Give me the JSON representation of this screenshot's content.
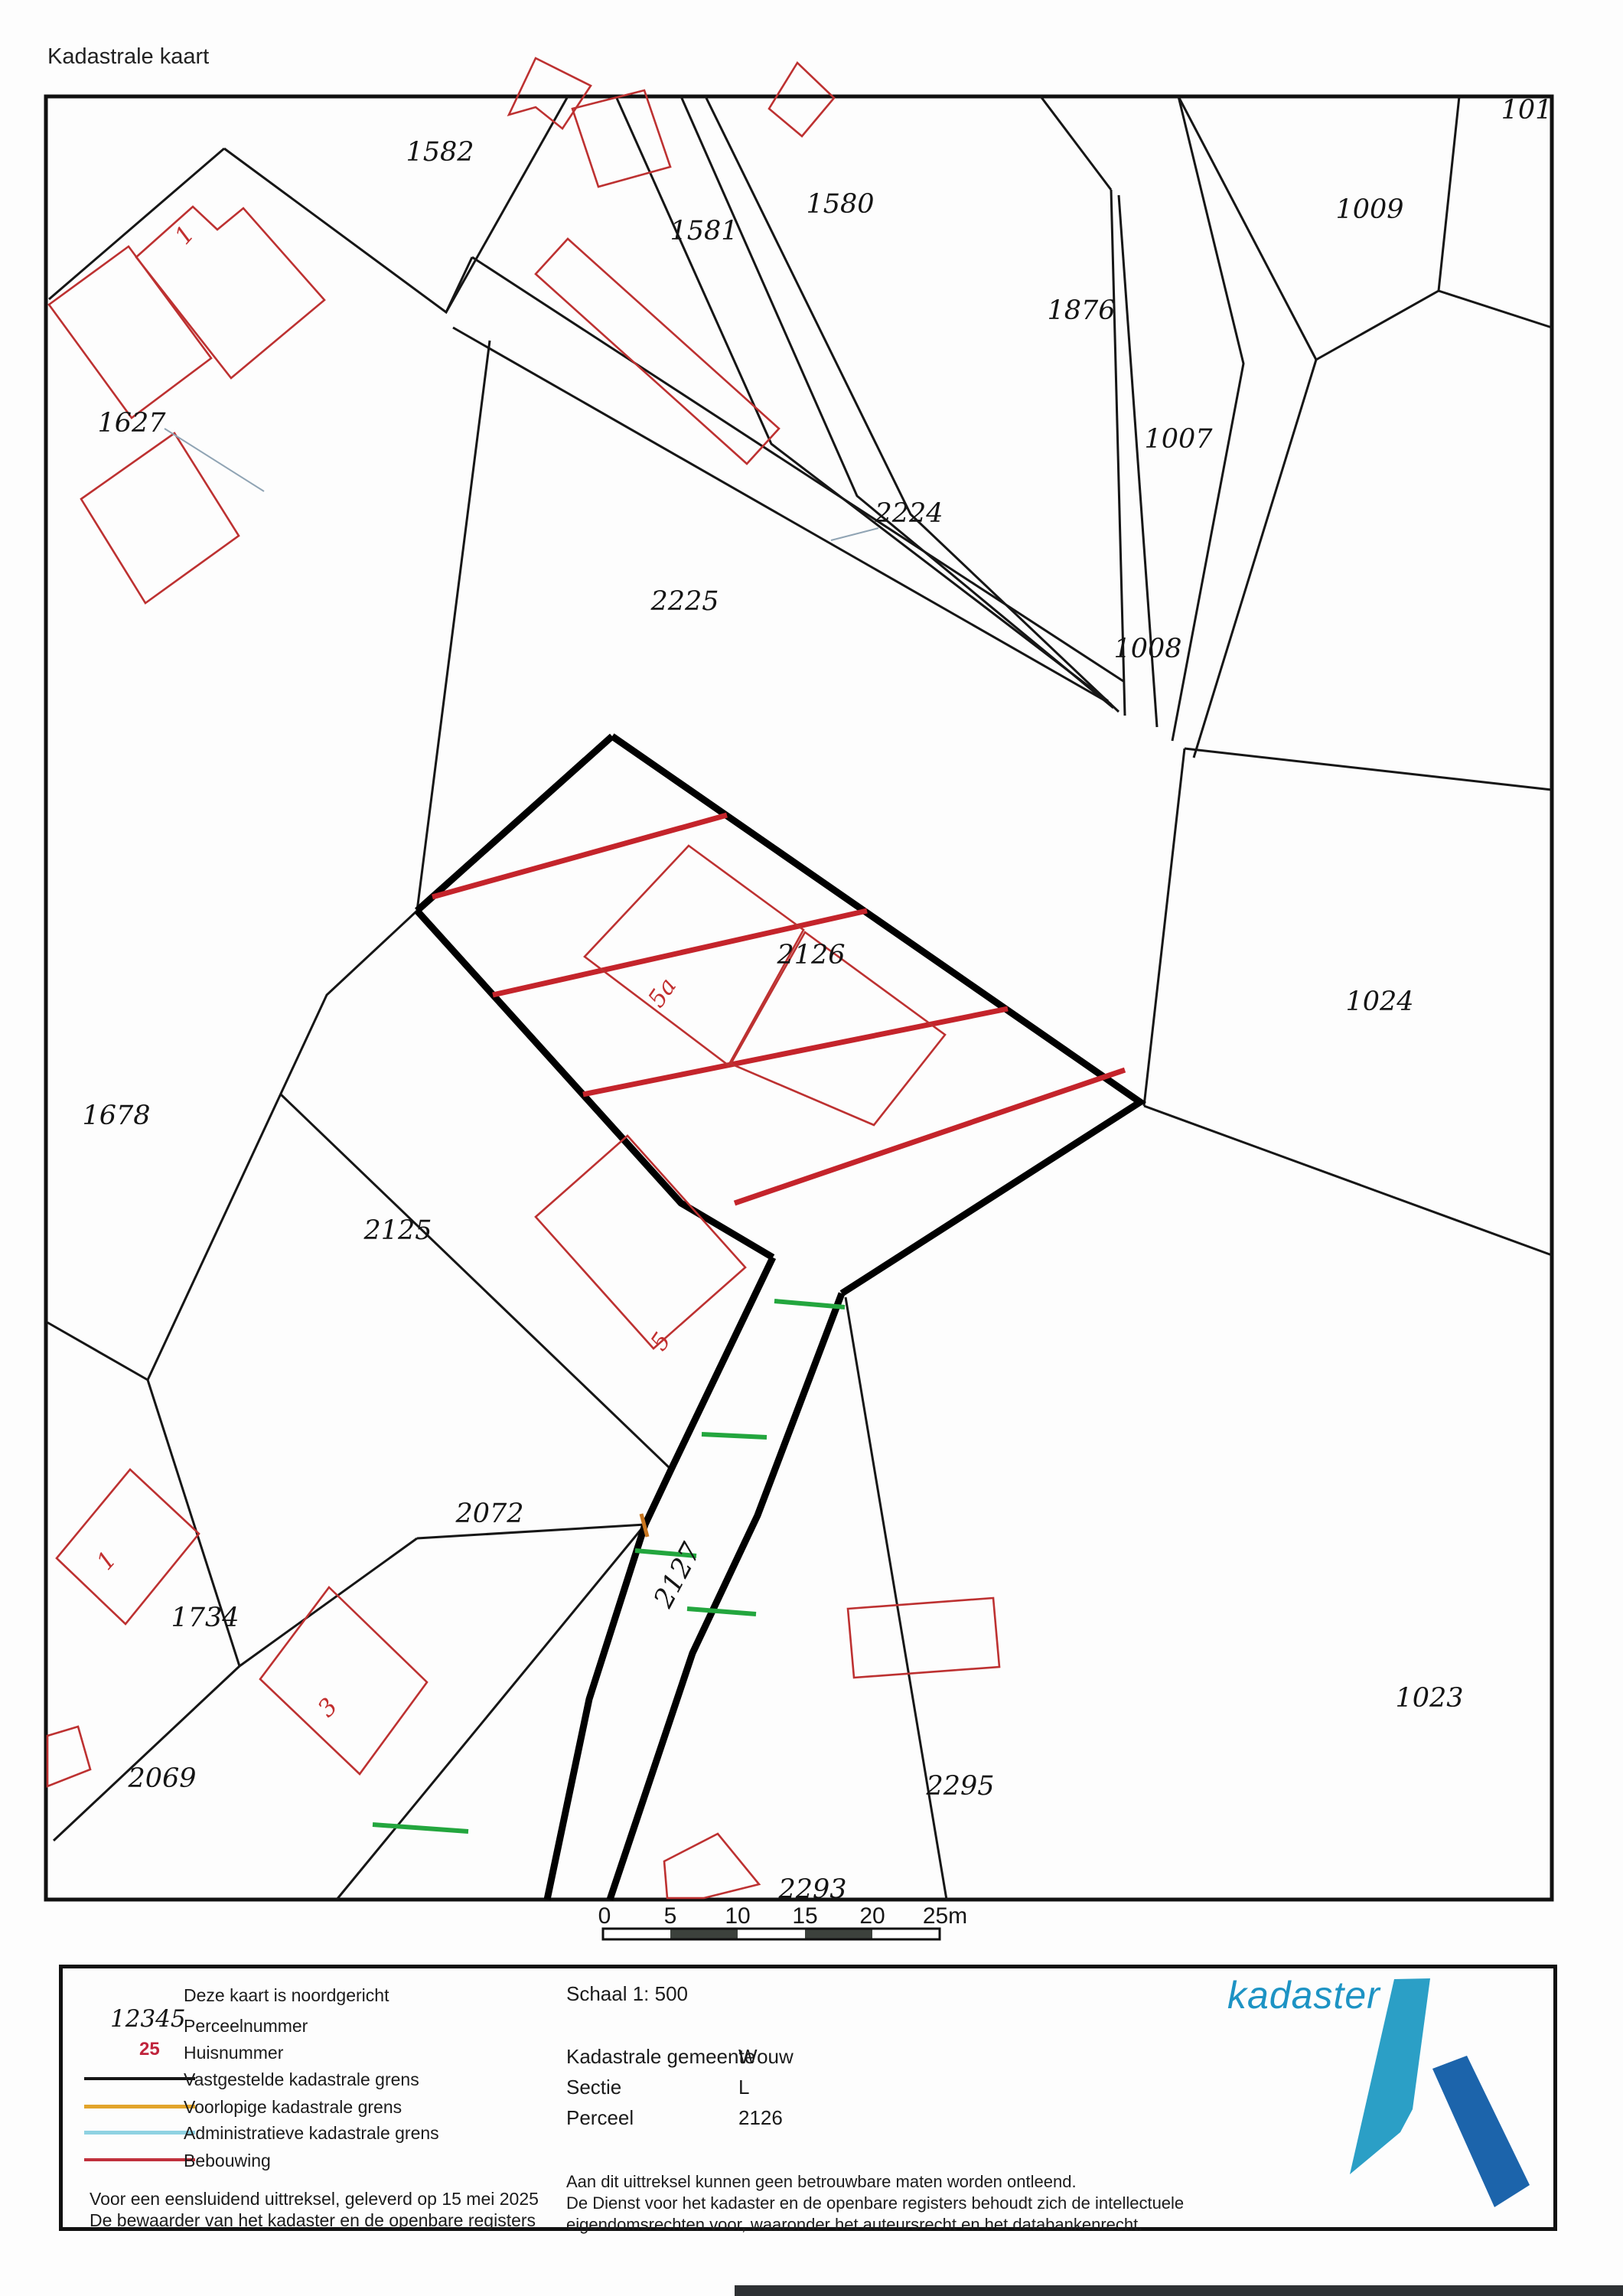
{
  "page": {
    "title": "Kadastrale kaart"
  },
  "map": {
    "parcels": [
      {
        "label": "1582"
      },
      {
        "label": "1581"
      },
      {
        "label": "1580"
      },
      {
        "label": "1876"
      },
      {
        "label": "1009"
      },
      {
        "label": "1007"
      },
      {
        "label": "1627"
      },
      {
        "label": "2224"
      },
      {
        "label": "2225"
      },
      {
        "label": "1008"
      },
      {
        "label": "2126"
      },
      {
        "label": "1024"
      },
      {
        "label": "1678"
      },
      {
        "label": "2125"
      },
      {
        "label": "2072"
      },
      {
        "label": "1734"
      },
      {
        "label": "2069"
      },
      {
        "label": "1023"
      },
      {
        "label": "2295"
      },
      {
        "label": "2293"
      },
      {
        "label": "2127"
      },
      {
        "label": "101"
      }
    ],
    "house_numbers": [
      {
        "label": "1"
      },
      {
        "label": "5a"
      },
      {
        "label": "5"
      },
      {
        "label": "1"
      },
      {
        "label": "3"
      }
    ]
  },
  "scale_bar": {
    "labels": [
      "0",
      "5",
      "10",
      "15",
      "20",
      "25m"
    ]
  },
  "legend": {
    "north_note": "Deze kaart is noordgericht",
    "items": [
      {
        "symbol": "12345",
        "label": "Perceelnummer"
      },
      {
        "symbol": "25",
        "label": "Huisnummer"
      },
      {
        "symbol": "line-black",
        "label": "Vastgestelde kadastrale grens"
      },
      {
        "symbol": "line-orange",
        "label": "Voorlopige kadastrale grens"
      },
      {
        "symbol": "line-lightblue",
        "label": "Administratieve kadastrale grens"
      },
      {
        "symbol": "line-red",
        "label": "Bebouwing"
      }
    ],
    "footer_line1": "Voor een eensluidend uittreksel, geleverd op 15 mei 2025",
    "footer_line2": "De bewaarder van het kadaster en de openbare registers"
  },
  "details": {
    "scale_label": "Schaal 1: 500",
    "gemeente_label": "Kadastrale gemeente",
    "gemeente_value": "Wouw",
    "sectie_label": "Sectie",
    "sectie_value": "L",
    "perceel_label": "Perceel",
    "perceel_value": "2126",
    "disclaimer_line1": "Aan dit uittreksel kunnen geen betrouwbare maten worden ontleend.",
    "disclaimer_line2": "De Dienst voor het kadaster en de openbare registers behoudt zich de intellectuele",
    "disclaimer_line3": "eigendomsrechten voor, waaronder het auteursrecht en het databankenrecht."
  },
  "logo": {
    "wordmark": "kadaster"
  },
  "colors": {
    "boundary_black": "#161616",
    "building_red": "#bd3131",
    "hatch_red": "#c4242b",
    "green_mark": "#23a63e",
    "orange_mark": "#c8761f",
    "legend_orange": "#e2a42a",
    "legend_lightblue": "#8fd2e2",
    "legend_red": "#c0303c",
    "logo_teal": "#2b9fc6",
    "logo_blue": "#1c64ab"
  }
}
